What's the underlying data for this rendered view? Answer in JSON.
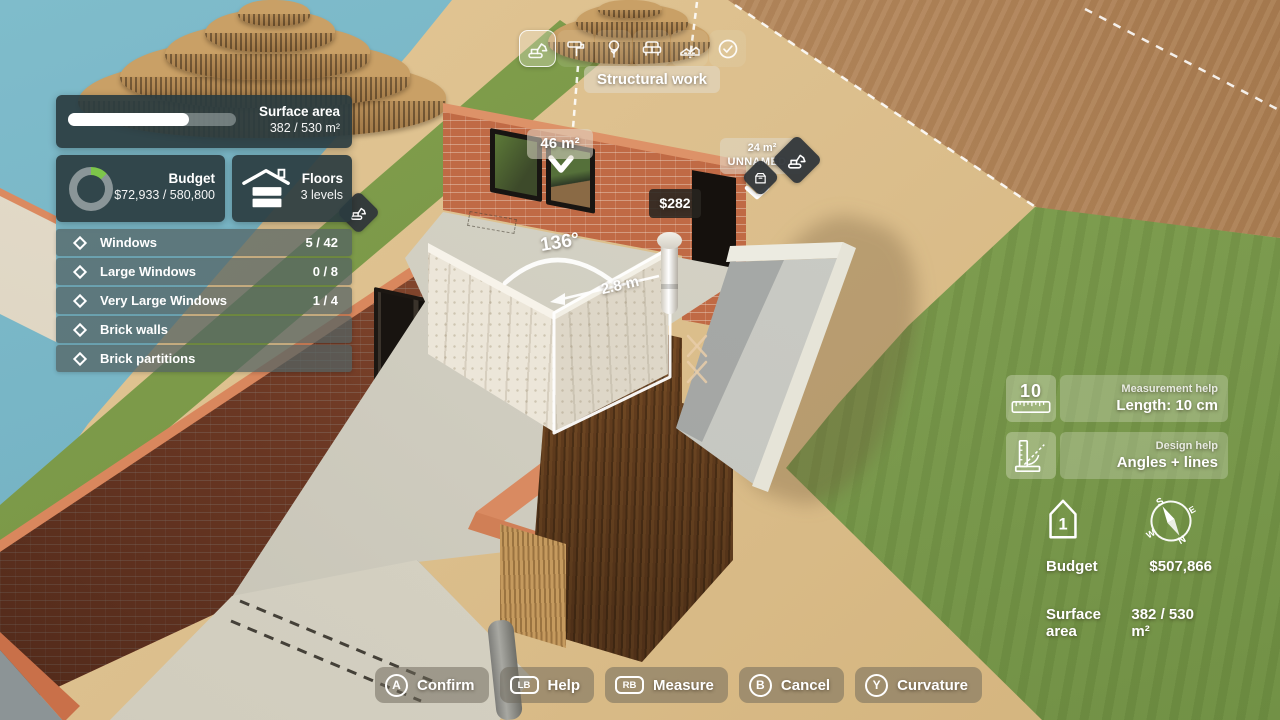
{
  "colors": {
    "accent_green": "#7dc64a",
    "panel_bg": "#2f4449",
    "water": "#79b7c7",
    "grass": "#7d9c4a",
    "sand": "#dcbf8d",
    "wood_desk": "#b8895c",
    "brick": "#c06a45",
    "selection": "#ffffff"
  },
  "toolbar": {
    "tooltip": "Structural work",
    "tools": [
      {
        "name": "structural-work",
        "selected": true
      },
      {
        "name": "painting",
        "selected": false
      },
      {
        "name": "landscaping",
        "selected": false
      },
      {
        "name": "furnishing",
        "selected": false
      },
      {
        "name": "terrain",
        "selected": false
      },
      {
        "name": "validate",
        "selected": false
      }
    ]
  },
  "surface_panel": {
    "label": "Surface area",
    "value": "382 / 530 m²",
    "progress_percent": 72
  },
  "budget_panel": {
    "label": "Budget",
    "value": "$72,933 / 580,800",
    "donut_percent": 12.6
  },
  "floors_panel": {
    "label": "Floors",
    "value": "3 levels"
  },
  "checklist": [
    {
      "label": "Windows",
      "count": "5 / 42"
    },
    {
      "label": "Large Windows",
      "count": "0 / 8"
    },
    {
      "label": "Very Large Windows",
      "count": "1 / 4"
    },
    {
      "label": "Brick walls",
      "count": ""
    },
    {
      "label": "Brick partitions",
      "count": ""
    }
  ],
  "scene": {
    "wall_area_label": "46 m²",
    "price_label": "$282",
    "room_badge_area": "24 m²",
    "room_badge_name": "UNNAMED 4",
    "angle_label": "136°",
    "length_label": "2.8 m"
  },
  "help_cards": [
    {
      "icon_value": "10",
      "category": "Measurement help",
      "value": "Length: 10 cm"
    },
    {
      "category": "Design help",
      "value": "Angles + lines"
    }
  ],
  "info_overlay": {
    "floor_number": "1",
    "budget_label": "Budget",
    "budget_value": "$507,866",
    "surface_label": "Surface area",
    "surface_value": "382 / 530 m²"
  },
  "action_bar": [
    {
      "key": "A",
      "label": "Confirm"
    },
    {
      "key": "LB",
      "label": "Help"
    },
    {
      "key": "RB",
      "label": "Measure"
    },
    {
      "key": "B",
      "label": "Cancel"
    },
    {
      "key": "Y",
      "label": "Curvature"
    }
  ]
}
